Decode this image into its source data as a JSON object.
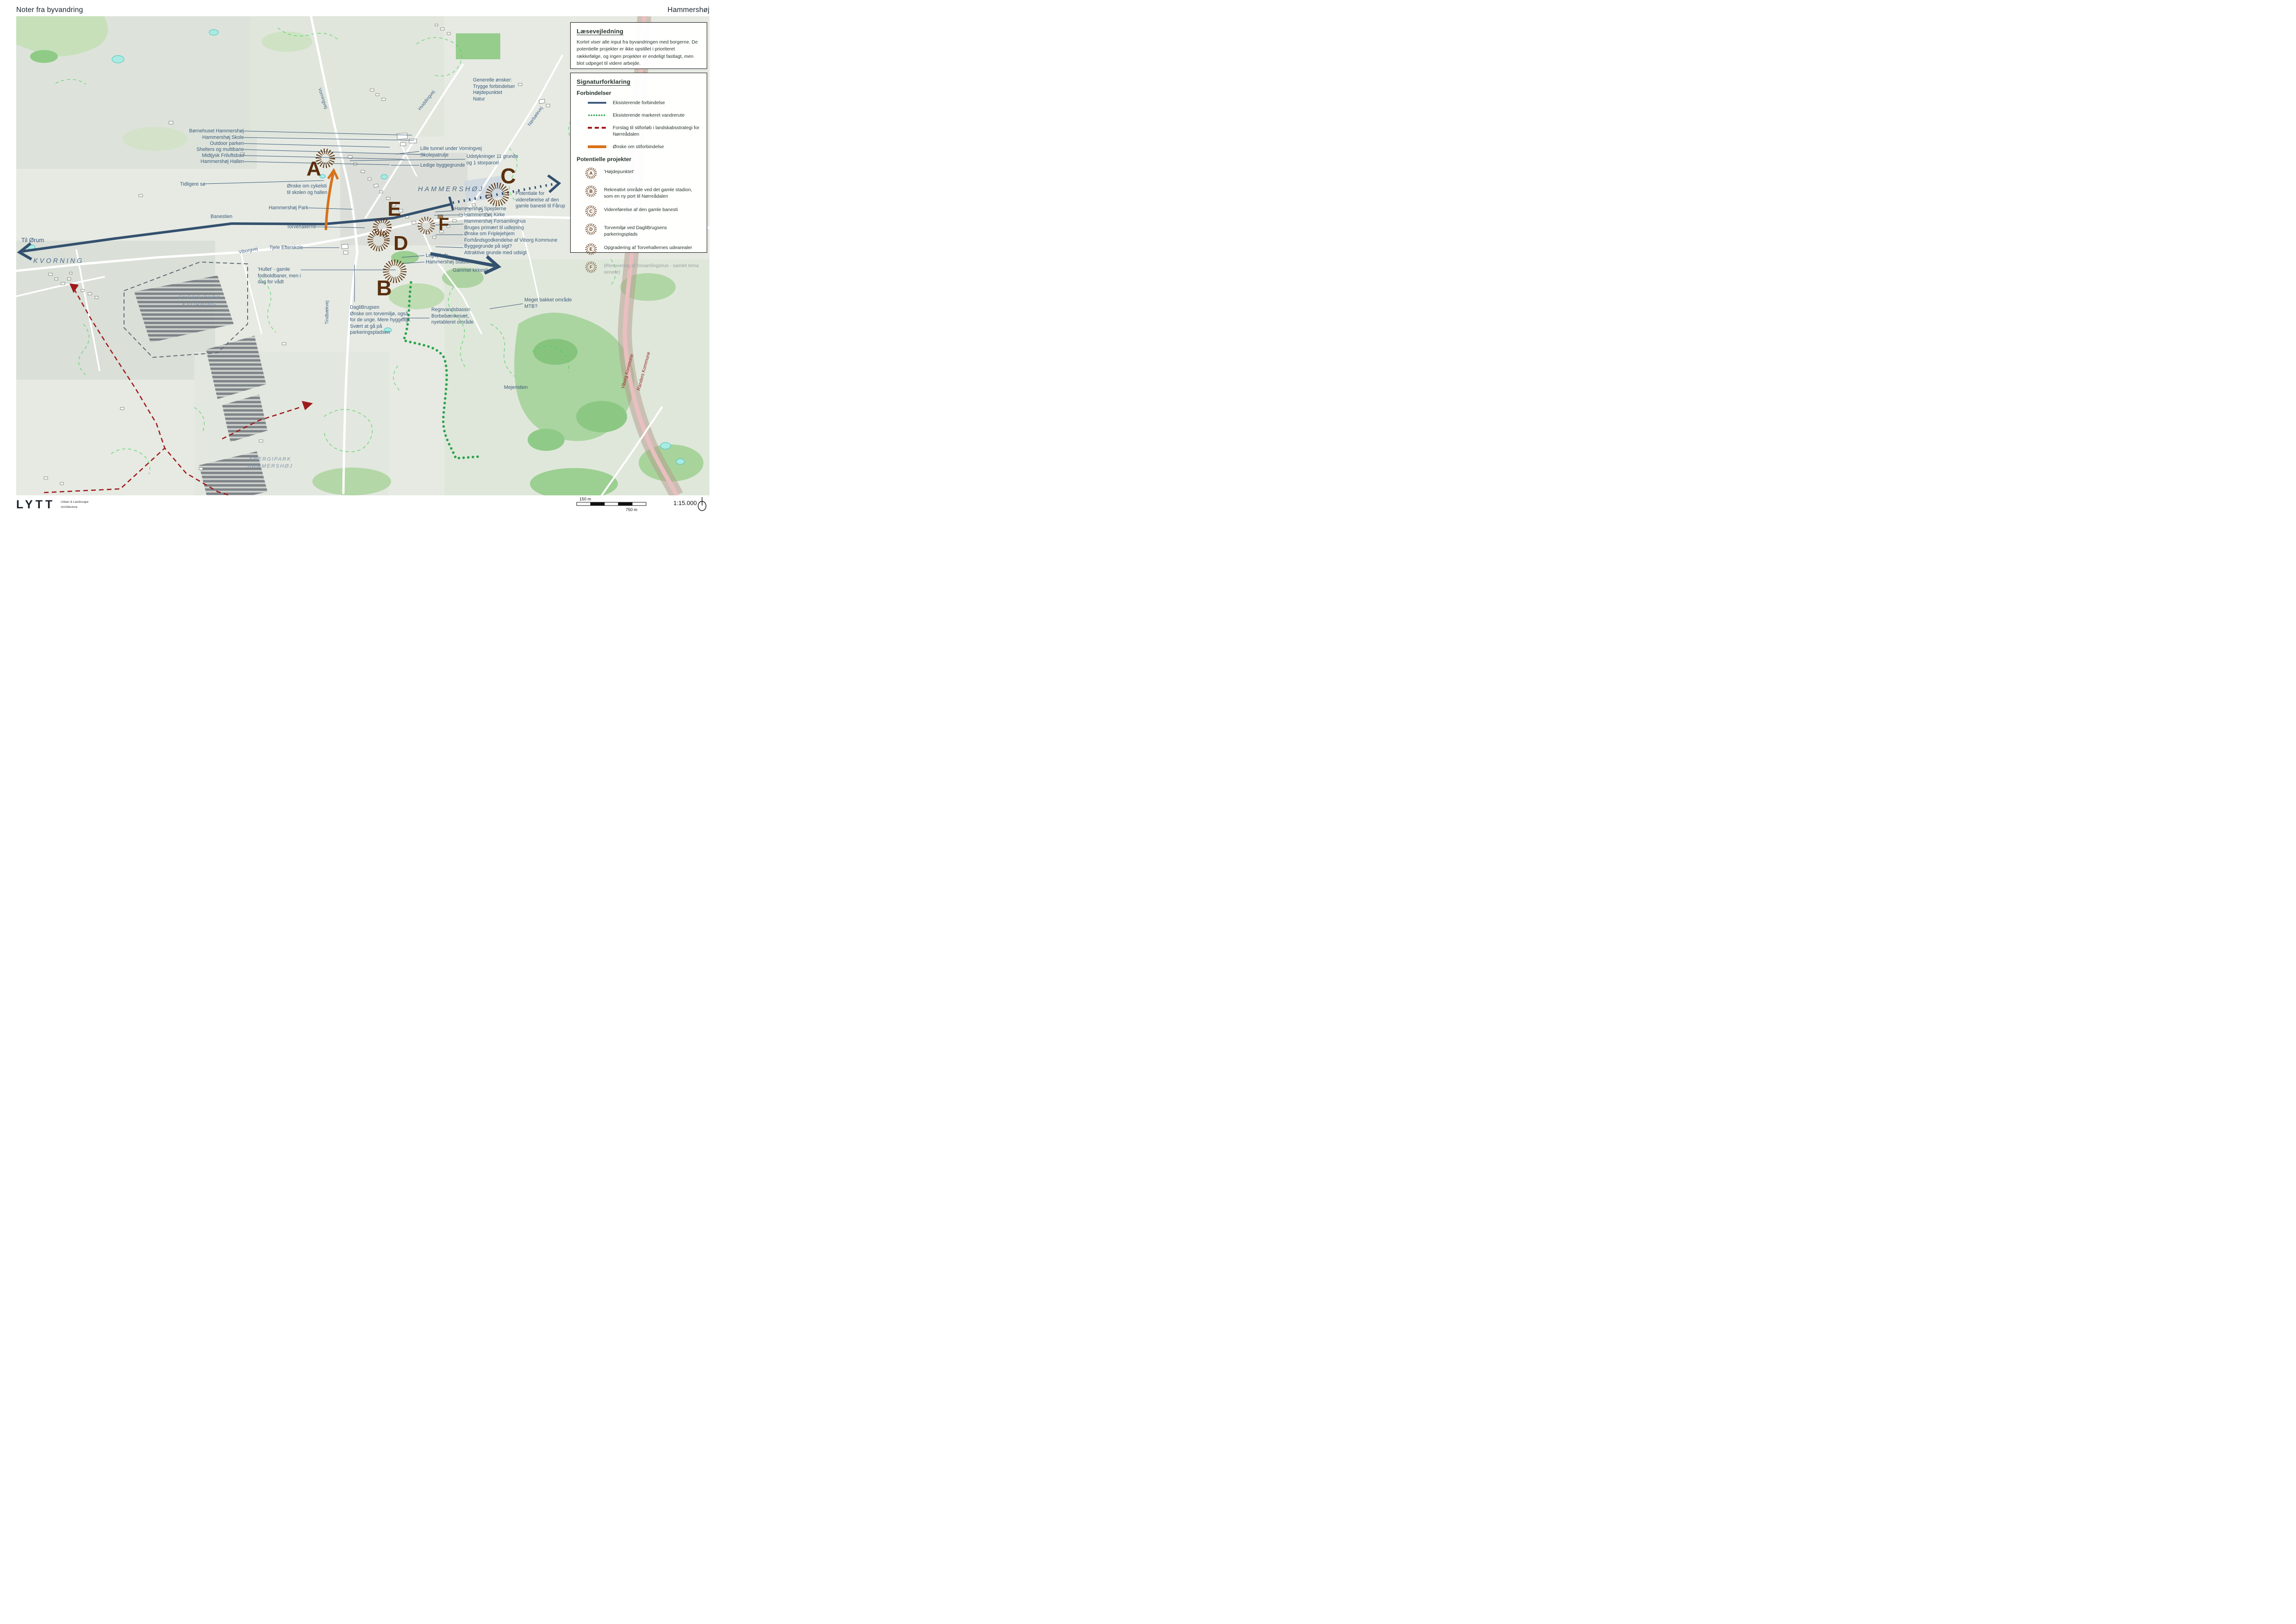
{
  "header": {
    "title": "Noter fra byvandring",
    "place": "Hammershøj"
  },
  "panels": {
    "reading_guide": {
      "title": "Læsevejledning",
      "body": "Kortet viser alle input fra byvandringen med borgerne. De potentielle projekter er ikke opstillet i prioriteret rækkefølge, og ingen projekter er endeligt fastlagt, men blot udpeget til videre arbejde."
    },
    "legend": {
      "title": "Signaturforklaring",
      "connections_title": "Forbindelser",
      "connections": [
        {
          "style": "solid-navy",
          "label": "Eksisterende forbindelse"
        },
        {
          "style": "dotted-green",
          "label": "Eksisterende markeret vandrerute"
        },
        {
          "style": "dashed-red",
          "label": "Forslag til stiforløb i landskabsstrategi for Nørreådalen"
        },
        {
          "style": "solid-orange",
          "label": "Ønske om stiforbindelse"
        }
      ],
      "projects_title": "Potentielle projekter",
      "projects": [
        {
          "letter": "A",
          "label": "'Højdepunktet'"
        },
        {
          "letter": "B",
          "label": "Rekreativt område ved det gamle stadion, som en ny port til Nørreådalen"
        },
        {
          "letter": "C",
          "label": "Videreførelse af den gamle banesti"
        },
        {
          "letter": "D",
          "label": "Torvemiljø ved DagliBrugsens parkeringsplads"
        },
        {
          "letter": "E",
          "label": "Opgradering af Torvehallernes udearealer"
        },
        {
          "letter": "F",
          "label": "(Renovering af forsamlingshus - samlet tema senere)"
        }
      ]
    }
  },
  "map": {
    "markers": {
      "a": "A",
      "b": "B",
      "c": "C",
      "d": "D",
      "e": "E",
      "f": "F"
    },
    "annotations": {
      "bornehuset": "Børnehuset Hammershøj",
      "skole": "Hammershøj Skole",
      "outdoor": "Outdoor parken",
      "shelters": "Shelters og multibane",
      "friluftsbad": "Midtjysk Friluftsbad",
      "hallen": "Hammershøj Hallen",
      "tidligere_so": "Tidligere sø",
      "cykelsti": "Ønske om cykelsti\ntil skolen og hallen",
      "park": "Hammershøj Park",
      "banestien": "Banestien",
      "torvehallerne": "Torvehallerne",
      "til_orum": "Til Ørum",
      "tjele": "Tjele Efterskole",
      "hullet": "'Hullet' - gamle\nfodboldbaner, men i\ndag for vådt",
      "daglibrugsen": "DagliBrugsen\nØnske om torvemiljø, også\nfor de unge. Mere hyggeligt.\nSvært at gå på\nparkeringspladsen",
      "regnvand": "Regnvandsbassin\nBorbebænkesæt,\nnyetableret område",
      "bakket": "Meget bakket område\nMTB?",
      "legeplads": "Legeplads",
      "stadion": "Hammershøj Stadion",
      "kirkesti": "Gammel kirkesti",
      "mejeristien": "Mejeristien",
      "tunnel": "Lille tunnel under Vorningvej\nSkolepatrulje",
      "udstykninger": "Udstykninger 11 grunde\nog 1 storparcel",
      "ledige": "Ledige byggegrunde",
      "spejderne": "Hammershøj Spejderne",
      "kirke": "Hammershøj Kirke",
      "ejendom_block": "Hammershøj Forsamlinghus\nBruges primært til udlejning\nØnske om Friplejehjem\nForhåndsgodkendelse af Viborg Kommune\nByggegrunde på sigt?\nAttraktive grunde med udsigt",
      "potentiale": "Potentiale for\nvidereførelse af den\ngamle banesti til Fårup",
      "generelle": "Generelle ønsker:\nTrygge forbindelser\nHøjdepunktet\nNatur"
    },
    "places": {
      "kvorning": "KVORNING",
      "hammershoj": "HAMMERSHØJ",
      "energipark_kvorning": "ENERGIPARK\nKVORNING",
      "energipark_hammershoj": "ENERGIPARK\nHAMMERSHØJ"
    },
    "roads": {
      "vorningvej": "Vorningvej",
      "hviddingvej": "Hviddingvej",
      "norbaekvej": "Nørbækvej",
      "viborgvej": "Viborgvej",
      "tindbaekvej": "Tindbækvej",
      "viborg_kommune": "Viborg Kommune",
      "randers_kommune": "Randers Kommune"
    },
    "colors": {
      "existing_connection": "#3f5a7d",
      "marked_hiking_route": "#2ea84f",
      "proposed_path": "#9e1a1c",
      "wished_path": "#d97118",
      "project_marker": "#5d330f",
      "annotation_text": "#3c5a7a",
      "municipality_text": "#8f1d1d"
    }
  },
  "footer": {
    "logo": "LYTT",
    "logo_sub1": "Urban & Landscape",
    "logo_sub2": "Architecture",
    "scale_left": "150 m",
    "scale_right": "750 m",
    "scale_ratio": "1:15.000"
  }
}
